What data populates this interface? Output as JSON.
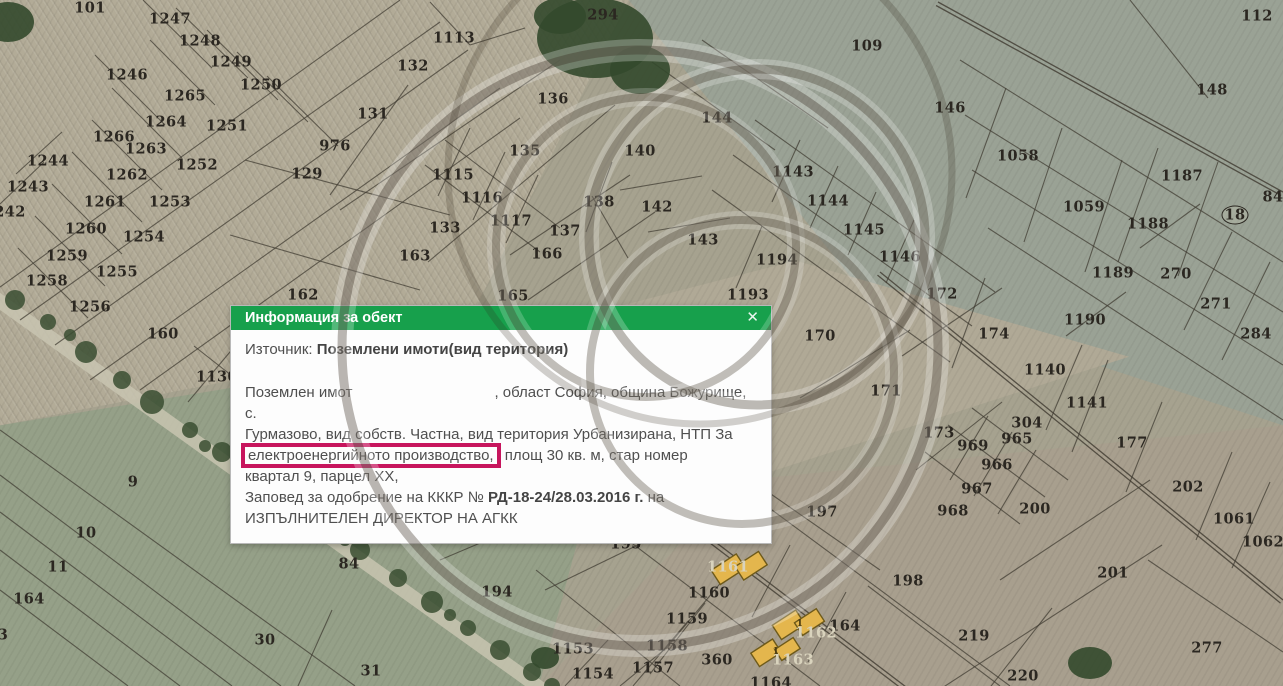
{
  "popup": {
    "title": "Информация за обект",
    "close_label": "✕",
    "source_label": "Източник:",
    "source_value": "Поземлени имоти(вид територия)",
    "body": {
      "l1_pre": "Поземлен имот",
      "l1_post": ", област София, община Божурище, с.",
      "l2": "Гурмазово, вид собств. Частна, вид територия Урбанизирана, НТП За",
      "l3_highlight": "електроенергийното производство,",
      "l3_post": " площ 30 кв. м, стар номер",
      "l4": "квартал 9, парцел ХХ,",
      "l5_pre": "Заповед за одобрение на КККР № ",
      "l5_bold": "РД-18-24/28.03.2016 г.",
      "l5_post": " на",
      "l6": "ИЗПЪЛНИТЕЛЕН ДИРЕКТОР НА АГКК"
    },
    "colors": {
      "header_green": "#17a04c",
      "highlight_red": "#c7155d"
    }
  },
  "map": {
    "labels": [
      {
        "t": "101",
        "x": 90,
        "y": 8
      },
      {
        "t": "1247",
        "x": 170,
        "y": 19
      },
      {
        "t": "1248",
        "x": 200,
        "y": 41
      },
      {
        "t": "1249",
        "x": 231,
        "y": 62
      },
      {
        "t": "1250",
        "x": 261,
        "y": 85
      },
      {
        "t": "1246",
        "x": 127,
        "y": 75
      },
      {
        "t": "1265",
        "x": 185,
        "y": 96
      },
      {
        "t": "1264",
        "x": 166,
        "y": 122
      },
      {
        "t": "1251",
        "x": 227,
        "y": 126
      },
      {
        "t": "1266",
        "x": 114,
        "y": 137
      },
      {
        "t": "1263",
        "x": 146,
        "y": 149
      },
      {
        "t": "1244",
        "x": 48,
        "y": 161
      },
      {
        "t": "1262",
        "x": 127,
        "y": 175
      },
      {
        "t": "1243",
        "x": 28,
        "y": 187
      },
      {
        "t": "242",
        "x": 10,
        "y": 212
      },
      {
        "t": "1261",
        "x": 105,
        "y": 202
      },
      {
        "t": "1253",
        "x": 170,
        "y": 202
      },
      {
        "t": "1252",
        "x": 197,
        "y": 165
      },
      {
        "t": "1260",
        "x": 86,
        "y": 229
      },
      {
        "t": "1254",
        "x": 144,
        "y": 237
      },
      {
        "t": "1259",
        "x": 67,
        "y": 256
      },
      {
        "t": "1255",
        "x": 117,
        "y": 272
      },
      {
        "t": "1258",
        "x": 47,
        "y": 281
      },
      {
        "t": "1256",
        "x": 90,
        "y": 307
      },
      {
        "t": "160",
        "x": 163,
        "y": 334
      },
      {
        "t": "976",
        "x": 335,
        "y": 146
      },
      {
        "t": "129",
        "x": 307,
        "y": 174
      },
      {
        "t": "133",
        "x": 445,
        "y": 228
      },
      {
        "t": "163",
        "x": 415,
        "y": 256
      },
      {
        "t": "162",
        "x": 303,
        "y": 295
      },
      {
        "t": "132",
        "x": 413,
        "y": 66
      },
      {
        "t": "1113",
        "x": 454,
        "y": 38
      },
      {
        "t": "131",
        "x": 373,
        "y": 114
      },
      {
        "t": "136",
        "x": 553,
        "y": 99
      },
      {
        "t": "135",
        "x": 525,
        "y": 151
      },
      {
        "t": "140",
        "x": 640,
        "y": 151
      },
      {
        "t": "1115",
        "x": 453,
        "y": 175
      },
      {
        "t": "1116",
        "x": 482,
        "y": 198
      },
      {
        "t": "138",
        "x": 599,
        "y": 202
      },
      {
        "t": "142",
        "x": 657,
        "y": 207
      },
      {
        "t": "1117",
        "x": 511,
        "y": 221
      },
      {
        "t": "137",
        "x": 565,
        "y": 231
      },
      {
        "t": "166",
        "x": 547,
        "y": 254
      },
      {
        "t": "165",
        "x": 513,
        "y": 296
      },
      {
        "t": "294",
        "x": 603,
        "y": 15
      },
      {
        "t": "109",
        "x": 867,
        "y": 46
      },
      {
        "t": "144",
        "x": 717,
        "y": 118
      },
      {
        "t": "143",
        "x": 703,
        "y": 240
      },
      {
        "t": "1143",
        "x": 793,
        "y": 172
      },
      {
        "t": "1144",
        "x": 828,
        "y": 201
      },
      {
        "t": "1145",
        "x": 864,
        "y": 230
      },
      {
        "t": "1146",
        "x": 900,
        "y": 257
      },
      {
        "t": "1194",
        "x": 777,
        "y": 260
      },
      {
        "t": "1193",
        "x": 748,
        "y": 295
      },
      {
        "t": "172",
        "x": 942,
        "y": 294
      },
      {
        "t": "170",
        "x": 820,
        "y": 336
      },
      {
        "t": "174",
        "x": 994,
        "y": 334
      },
      {
        "t": "171",
        "x": 886,
        "y": 391
      },
      {
        "t": "112",
        "x": 1257,
        "y": 16
      },
      {
        "t": "148",
        "x": 1212,
        "y": 90
      },
      {
        "t": "146",
        "x": 950,
        "y": 108
      },
      {
        "t": "1058",
        "x": 1018,
        "y": 156
      },
      {
        "t": "1187",
        "x": 1182,
        "y": 176
      },
      {
        "t": "1059",
        "x": 1084,
        "y": 207
      },
      {
        "t": "1188",
        "x": 1148,
        "y": 224
      },
      {
        "t": "84",
        "x": 1273,
        "y": 197
      },
      {
        "t": "1189",
        "x": 1113,
        "y": 273
      },
      {
        "t": "270",
        "x": 1176,
        "y": 274
      },
      {
        "t": "271",
        "x": 1216,
        "y": 304
      },
      {
        "t": "284",
        "x": 1256,
        "y": 334
      },
      {
        "t": "1190",
        "x": 1085,
        "y": 320
      },
      {
        "t": "1140",
        "x": 1045,
        "y": 370
      },
      {
        "t": "1141",
        "x": 1087,
        "y": 403
      },
      {
        "t": "177",
        "x": 1132,
        "y": 443
      },
      {
        "t": "304",
        "x": 1027,
        "y": 423
      },
      {
        "t": "173",
        "x": 939,
        "y": 433
      },
      {
        "t": "969",
        "x": 973,
        "y": 446
      },
      {
        "t": "965",
        "x": 1017,
        "y": 439
      },
      {
        "t": "966",
        "x": 997,
        "y": 465
      },
      {
        "t": "967",
        "x": 977,
        "y": 489
      },
      {
        "t": "202",
        "x": 1188,
        "y": 487
      },
      {
        "t": "968",
        "x": 953,
        "y": 511
      },
      {
        "t": "200",
        "x": 1035,
        "y": 509
      },
      {
        "t": "1061",
        "x": 1234,
        "y": 519
      },
      {
        "t": "1062",
        "x": 1263,
        "y": 542
      },
      {
        "t": "201",
        "x": 1113,
        "y": 573
      },
      {
        "t": "219",
        "x": 974,
        "y": 636
      },
      {
        "t": "277",
        "x": 1207,
        "y": 648
      },
      {
        "t": "220",
        "x": 1023,
        "y": 676
      },
      {
        "t": "197",
        "x": 822,
        "y": 512
      },
      {
        "t": "195",
        "x": 626,
        "y": 544
      },
      {
        "t": "198",
        "x": 908,
        "y": 581
      },
      {
        "t": "1160",
        "x": 709,
        "y": 593
      },
      {
        "t": "1159",
        "x": 687,
        "y": 619
      },
      {
        "t": "1158",
        "x": 667,
        "y": 646
      },
      {
        "t": "1157",
        "x": 653,
        "y": 668
      },
      {
        "t": "1153",
        "x": 573,
        "y": 649
      },
      {
        "t": "1154",
        "x": 593,
        "y": 674
      },
      {
        "t": "360",
        "x": 717,
        "y": 660
      },
      {
        "t": "164",
        "x": 845,
        "y": 626
      },
      {
        "t": "1164",
        "x": 771,
        "y": 683
      },
      {
        "t": "1130",
        "x": 217,
        "y": 377
      },
      {
        "t": "9",
        "x": 133,
        "y": 482
      },
      {
        "t": "10",
        "x": 86,
        "y": 533
      },
      {
        "t": "11",
        "x": 58,
        "y": 567
      },
      {
        "t": "164",
        "x": 29,
        "y": 599
      },
      {
        "t": "3",
        "x": 3,
        "y": 635
      },
      {
        "t": "30",
        "x": 265,
        "y": 640
      },
      {
        "t": "84",
        "x": 349,
        "y": 564
      },
      {
        "t": "194",
        "x": 497,
        "y": 592
      },
      {
        "t": "31",
        "x": 371,
        "y": 671
      },
      {
        "t": "69",
        "x": 254,
        "y": 518
      },
      {
        "t": "1161",
        "x": 728,
        "y": 567,
        "cls": "light"
      },
      {
        "t": "1162",
        "x": 816,
        "y": 633,
        "cls": "light"
      },
      {
        "t": "1163",
        "x": 793,
        "y": 660,
        "cls": "light"
      },
      {
        "t": "1",
        "x": 800,
        "y": 624,
        "cls": "bsmall"
      },
      {
        "t": "1",
        "x": 776,
        "y": 652,
        "cls": "bsmall"
      },
      {
        "t": "18",
        "x": 1235,
        "y": 215,
        "cls": "ringed"
      }
    ],
    "lines": [
      [
        400,
        0,
        0,
        287
      ],
      [
        440,
        22,
        20,
        320
      ],
      [
        468,
        50,
        55,
        345
      ],
      [
        500,
        88,
        90,
        380
      ],
      [
        520,
        118,
        140,
        390
      ],
      [
        143,
        0,
        212,
        68
      ],
      [
        176,
        8,
        248,
        78
      ],
      [
        207,
        30,
        278,
        100
      ],
      [
        237,
        52,
        308,
        122
      ],
      [
        267,
        76,
        338,
        146
      ],
      [
        150,
        40,
        215,
        105
      ],
      [
        95,
        55,
        165,
        125
      ],
      [
        112,
        88,
        182,
        158
      ],
      [
        92,
        120,
        162,
        190
      ],
      [
        72,
        152,
        142,
        222
      ],
      [
        52,
        184,
        122,
        254
      ],
      [
        35,
        216,
        105,
        286
      ],
      [
        18,
        248,
        88,
        318
      ],
      [
        62,
        132,
        16,
        174
      ],
      [
        44,
        162,
        0,
        204
      ],
      [
        245,
        160,
        450,
        215
      ],
      [
        230,
        235,
        420,
        290
      ],
      [
        408,
        85,
        330,
        195
      ],
      [
        340,
        210,
        560,
        60
      ],
      [
        428,
        262,
        615,
        105
      ],
      [
        430,
        2,
        470,
        45
      ],
      [
        470,
        45,
        525,
        28
      ],
      [
        194,
        346,
        250,
        390
      ],
      [
        240,
        340,
        188,
        402
      ],
      [
        0,
        430,
        355,
        686
      ],
      [
        0,
        475,
        281,
        686
      ],
      [
        0,
        512,
        232,
        686
      ],
      [
        0,
        550,
        180,
        686
      ],
      [
        0,
        590,
        128,
        686
      ],
      [
        332,
        610,
        298,
        686
      ],
      [
        440,
        560,
        596,
        494
      ],
      [
        425,
        165,
        540,
        252
      ],
      [
        445,
        140,
        560,
        228
      ],
      [
        470,
        128,
        438,
        196
      ],
      [
        505,
        152,
        473,
        220
      ],
      [
        538,
        175,
        506,
        243
      ],
      [
        510,
        255,
        630,
        175
      ],
      [
        528,
        300,
        655,
        212
      ],
      [
        592,
        196,
        628,
        258
      ],
      [
        612,
        162,
        586,
        232
      ],
      [
        620,
        190,
        702,
        176
      ],
      [
        648,
        232,
        730,
        218
      ],
      [
        652,
        62,
        775,
        150
      ],
      [
        702,
        40,
        828,
        128
      ],
      [
        755,
        120,
        995,
        292
      ],
      [
        733,
        155,
        972,
        326
      ],
      [
        800,
        140,
        772,
        202
      ],
      [
        838,
        166,
        810,
        228
      ],
      [
        876,
        192,
        848,
        255
      ],
      [
        914,
        220,
        886,
        283
      ],
      [
        712,
        190,
        950,
        362
      ],
      [
        762,
        226,
        736,
        288
      ],
      [
        902,
        356,
        1002,
        288
      ],
      [
        985,
        278,
        952,
        368
      ],
      [
        800,
        398,
        910,
        330
      ],
      [
        960,
        60,
        1283,
        262
      ],
      [
        965,
        115,
        1283,
        312
      ],
      [
        972,
        170,
        1283,
        365
      ],
      [
        988,
        228,
        1283,
        420
      ],
      [
        1130,
        0,
        1208,
        98
      ],
      [
        1006,
        88,
        966,
        198
      ],
      [
        1062,
        128,
        1024,
        242
      ],
      [
        1122,
        160,
        1085,
        272
      ],
      [
        1200,
        204,
        1140,
        248
      ],
      [
        1126,
        292,
        1066,
        336
      ],
      [
        1232,
        232,
        1184,
        330
      ],
      [
        1270,
        262,
        1222,
        360
      ],
      [
        1158,
        148,
        1118,
        262
      ],
      [
        1218,
        162,
        1178,
        276
      ],
      [
        948,
        425,
        1045,
        497
      ],
      [
        925,
        452,
        1020,
        524
      ],
      [
        972,
        408,
        1068,
        480
      ],
      [
        988,
        416,
        950,
        480
      ],
      [
        1012,
        432,
        974,
        496
      ],
      [
        1036,
        450,
        998,
        514
      ],
      [
        916,
        470,
        1002,
        402
      ],
      [
        1000,
        580,
        1150,
        480
      ],
      [
        942,
        688,
        1162,
        545
      ],
      [
        1052,
        608,
        988,
        690
      ],
      [
        1148,
        560,
        1283,
        652
      ],
      [
        1270,
        482,
        1232,
        568
      ],
      [
        1232,
        452,
        1196,
        540
      ],
      [
        1162,
        402,
        1126,
        492
      ],
      [
        1108,
        360,
        1072,
        452
      ],
      [
        1082,
        345,
        1046,
        430
      ],
      [
        596,
        516,
        820,
        686
      ],
      [
        728,
        574,
        668,
        646
      ],
      [
        705,
        603,
        650,
        674
      ],
      [
        688,
        621,
        633,
        686
      ],
      [
        670,
        645,
        620,
        686
      ],
      [
        536,
        570,
        680,
        686
      ],
      [
        608,
        640,
        565,
        686
      ],
      [
        710,
        510,
        545,
        590
      ],
      [
        745,
        490,
        1010,
        686
      ],
      [
        790,
        545,
        752,
        617
      ],
      [
        846,
        592,
        808,
        662
      ],
      [
        868,
        586,
        1000,
        686
      ],
      [
        768,
        492,
        880,
        570
      ]
    ],
    "tree_road": [
      -20,
      287,
      565,
      706
    ],
    "double_roads": [
      [
        938,
        2,
        1283,
        192
      ],
      [
        880,
        272,
        1283,
        600
      ],
      [
        618,
        468,
        910,
        690
      ]
    ],
    "trees": [
      [
        15,
        300,
        10
      ],
      [
        48,
        322,
        8
      ],
      [
        86,
        352,
        11
      ],
      [
        122,
        380,
        9
      ],
      [
        152,
        402,
        12
      ],
      [
        190,
        430,
        8
      ],
      [
        222,
        452,
        10
      ],
      [
        258,
        478,
        9
      ],
      [
        292,
        502,
        12
      ],
      [
        326,
        527,
        8
      ],
      [
        360,
        550,
        10
      ],
      [
        398,
        578,
        9
      ],
      [
        432,
        602,
        11
      ],
      [
        468,
        628,
        8
      ],
      [
        500,
        650,
        10
      ],
      [
        532,
        672,
        9
      ],
      [
        552,
        686,
        8
      ],
      [
        70,
        335,
        6
      ],
      [
        205,
        446,
        6
      ],
      [
        345,
        540,
        6
      ],
      [
        450,
        615,
        6
      ]
    ],
    "woods": [
      [
        595,
        38,
        58,
        40
      ],
      [
        640,
        70,
        30,
        24
      ],
      [
        560,
        16,
        26,
        18
      ],
      [
        8,
        22,
        26,
        20
      ],
      [
        1090,
        663,
        22,
        16
      ],
      [
        545,
        658,
        14,
        11
      ]
    ],
    "buildings": [
      {
        "cx": 740,
        "cy": 567,
        "rot": -33,
        "rects": [
          [
            -26,
            -13,
            30,
            17
          ],
          [
            -4,
            -3,
            28,
            16
          ]
        ]
      },
      {
        "cx": 800,
        "cy": 624,
        "rot": -33,
        "rects": [
          [
            -24,
            -14,
            28,
            17
          ],
          [
            -4,
            -4,
            26,
            15
          ]
        ]
      },
      {
        "cx": 778,
        "cy": 651,
        "rot": -33,
        "rects": [
          [
            -24,
            -13,
            26,
            16
          ],
          [
            -2,
            -3,
            22,
            13
          ]
        ]
      }
    ]
  }
}
